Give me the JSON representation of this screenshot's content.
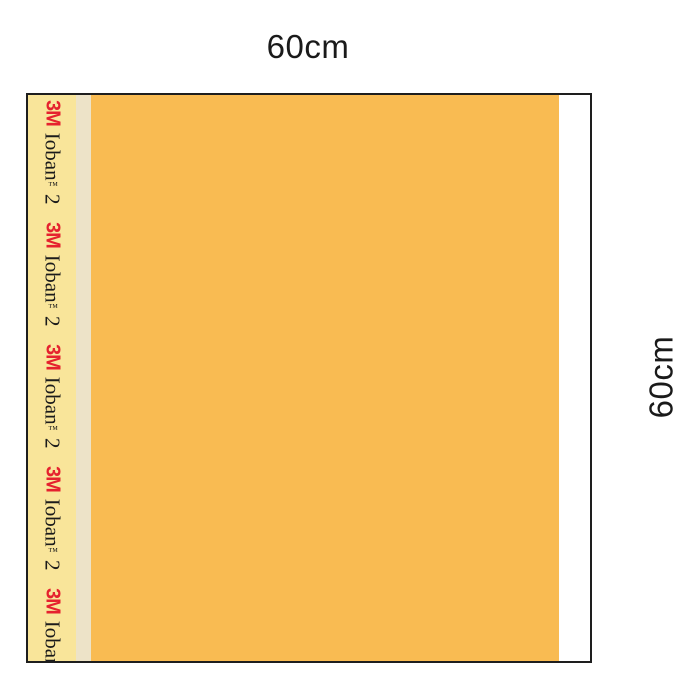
{
  "diagram": {
    "labels": {
      "top_width": "60cm",
      "right_height": "60cm"
    },
    "tape_print": {
      "brand": "3M",
      "product": "Ioban",
      "trademark_symbol": "™",
      "version": "2",
      "repetitions": 5
    },
    "colors": {
      "film_orange": "#F9BB52",
      "tape_yellow": "#F9E59A",
      "liner_cream": "#EDE3C8",
      "edge_white": "#FFFFFF",
      "brand_red": "#E5212E",
      "outline": "#1E1E1E",
      "label_text": "#1A1A1A",
      "print_black": "#1B1B1B"
    }
  }
}
